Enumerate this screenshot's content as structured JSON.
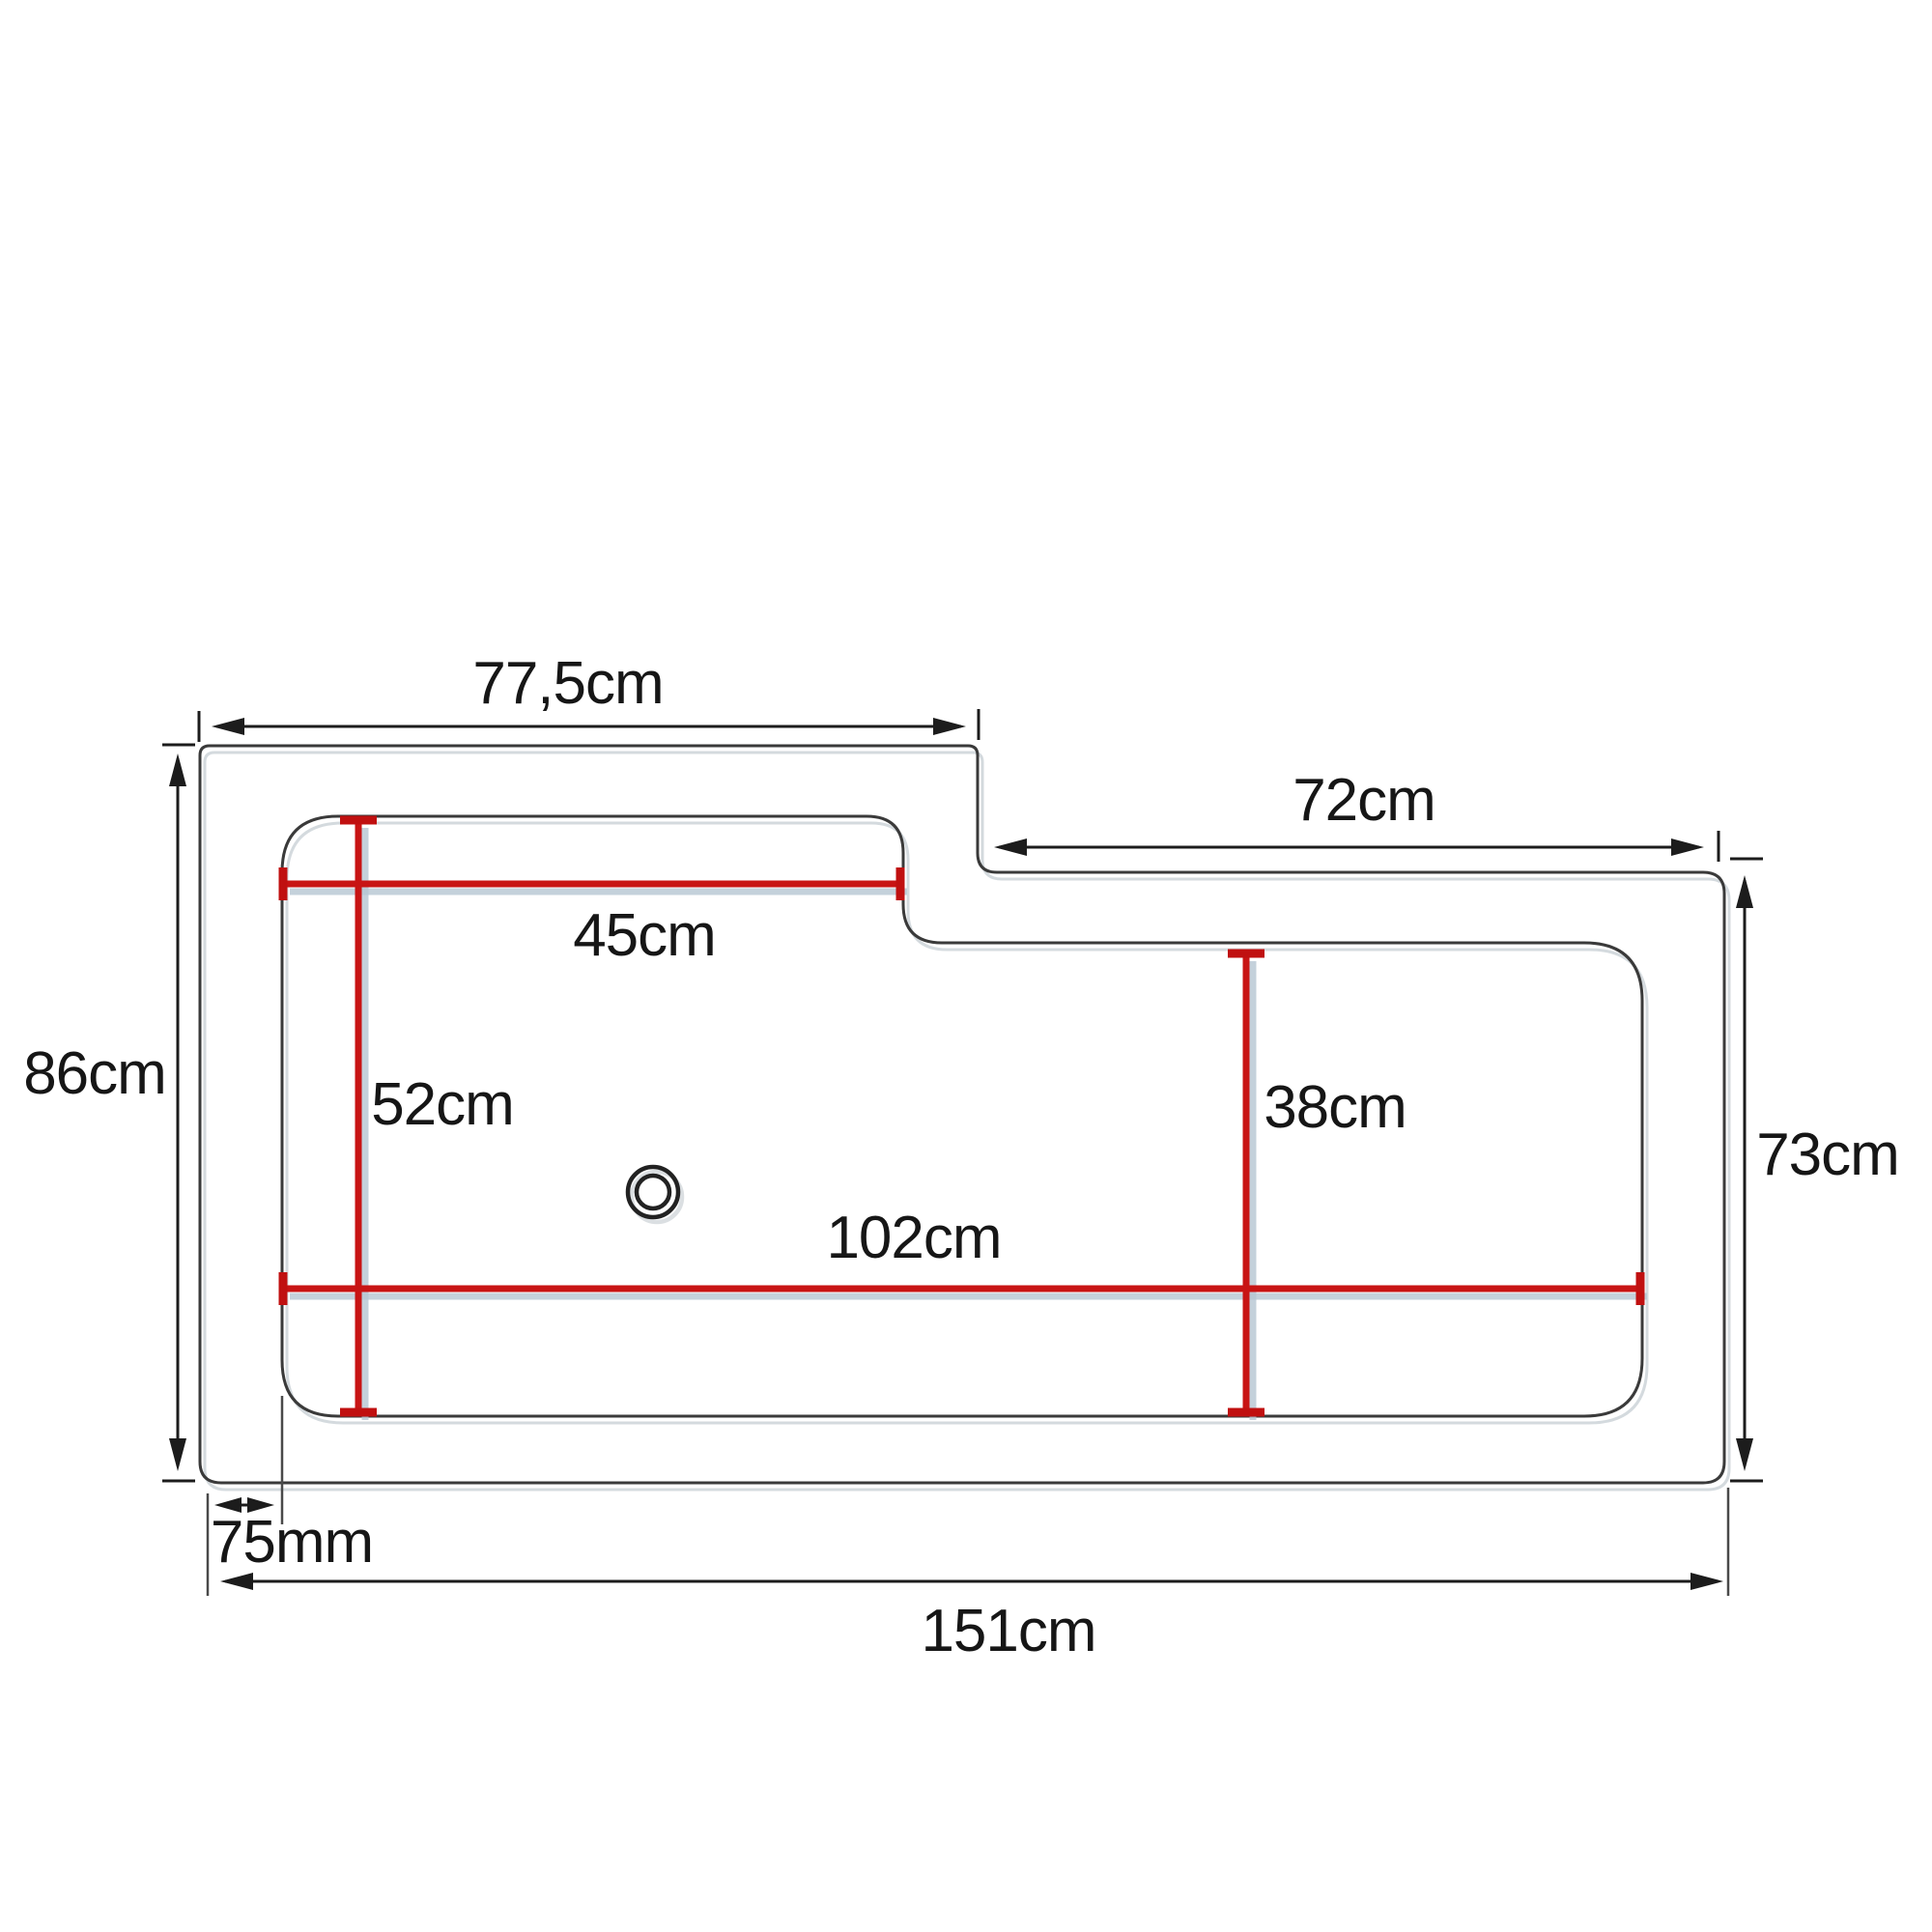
{
  "measurements": {
    "top_width_left": "77,5cm",
    "top_width_right": "72cm",
    "height_left": "86cm",
    "height_right": "73cm",
    "inner_width_top": "45cm",
    "inner_height_left": "52cm",
    "inner_height_right": "38cm",
    "inner_width_bottom": "102cm",
    "edge_offset": "75mm",
    "total_width": "151cm"
  },
  "colors": {
    "background": "#ffffff",
    "outline": "#3a3a3a",
    "dimension_lines": "#1c1c1c",
    "measure_lines": "#c81414",
    "measure_shadow": "#b5c6d2",
    "text": "#161616"
  }
}
